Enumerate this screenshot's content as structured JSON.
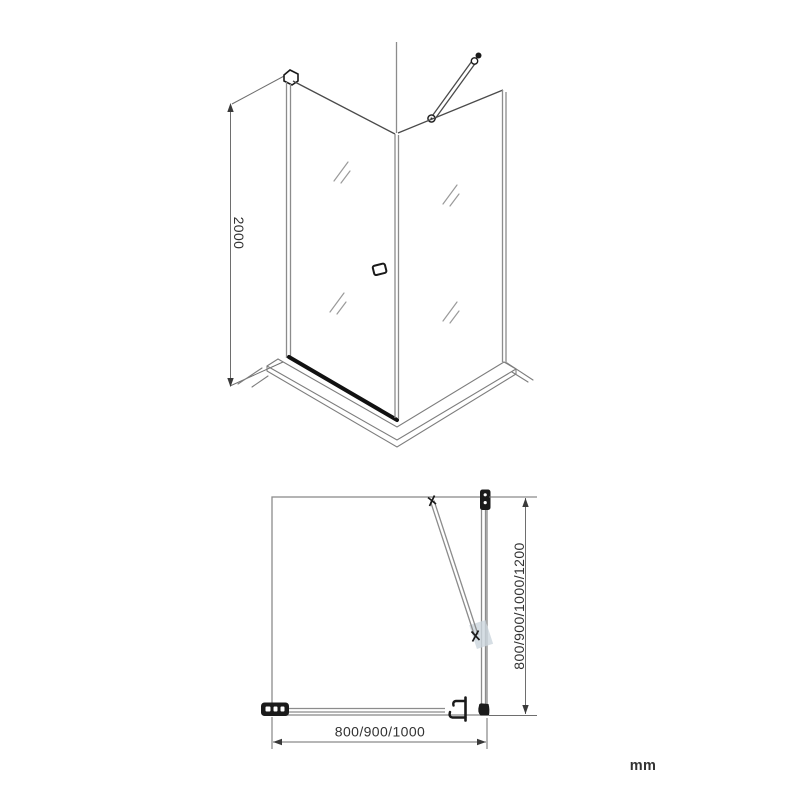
{
  "front_view": {
    "height_dimension": {
      "label": "2000"
    }
  },
  "plan_view": {
    "depth_dimension": {
      "label": "800/900/1000/1200"
    },
    "width_dimension": {
      "label": "800/900/1000"
    }
  },
  "unit_label": "mm",
  "colors": {
    "background": "#ffffff",
    "glass_line_gray": "#8c8c8c",
    "dimension_gray": "#6e6e6e",
    "accent_black": "#1a1a1a",
    "text_dark": "#323232",
    "hinge_patch_blue_gray": "#ccd6dd"
  }
}
